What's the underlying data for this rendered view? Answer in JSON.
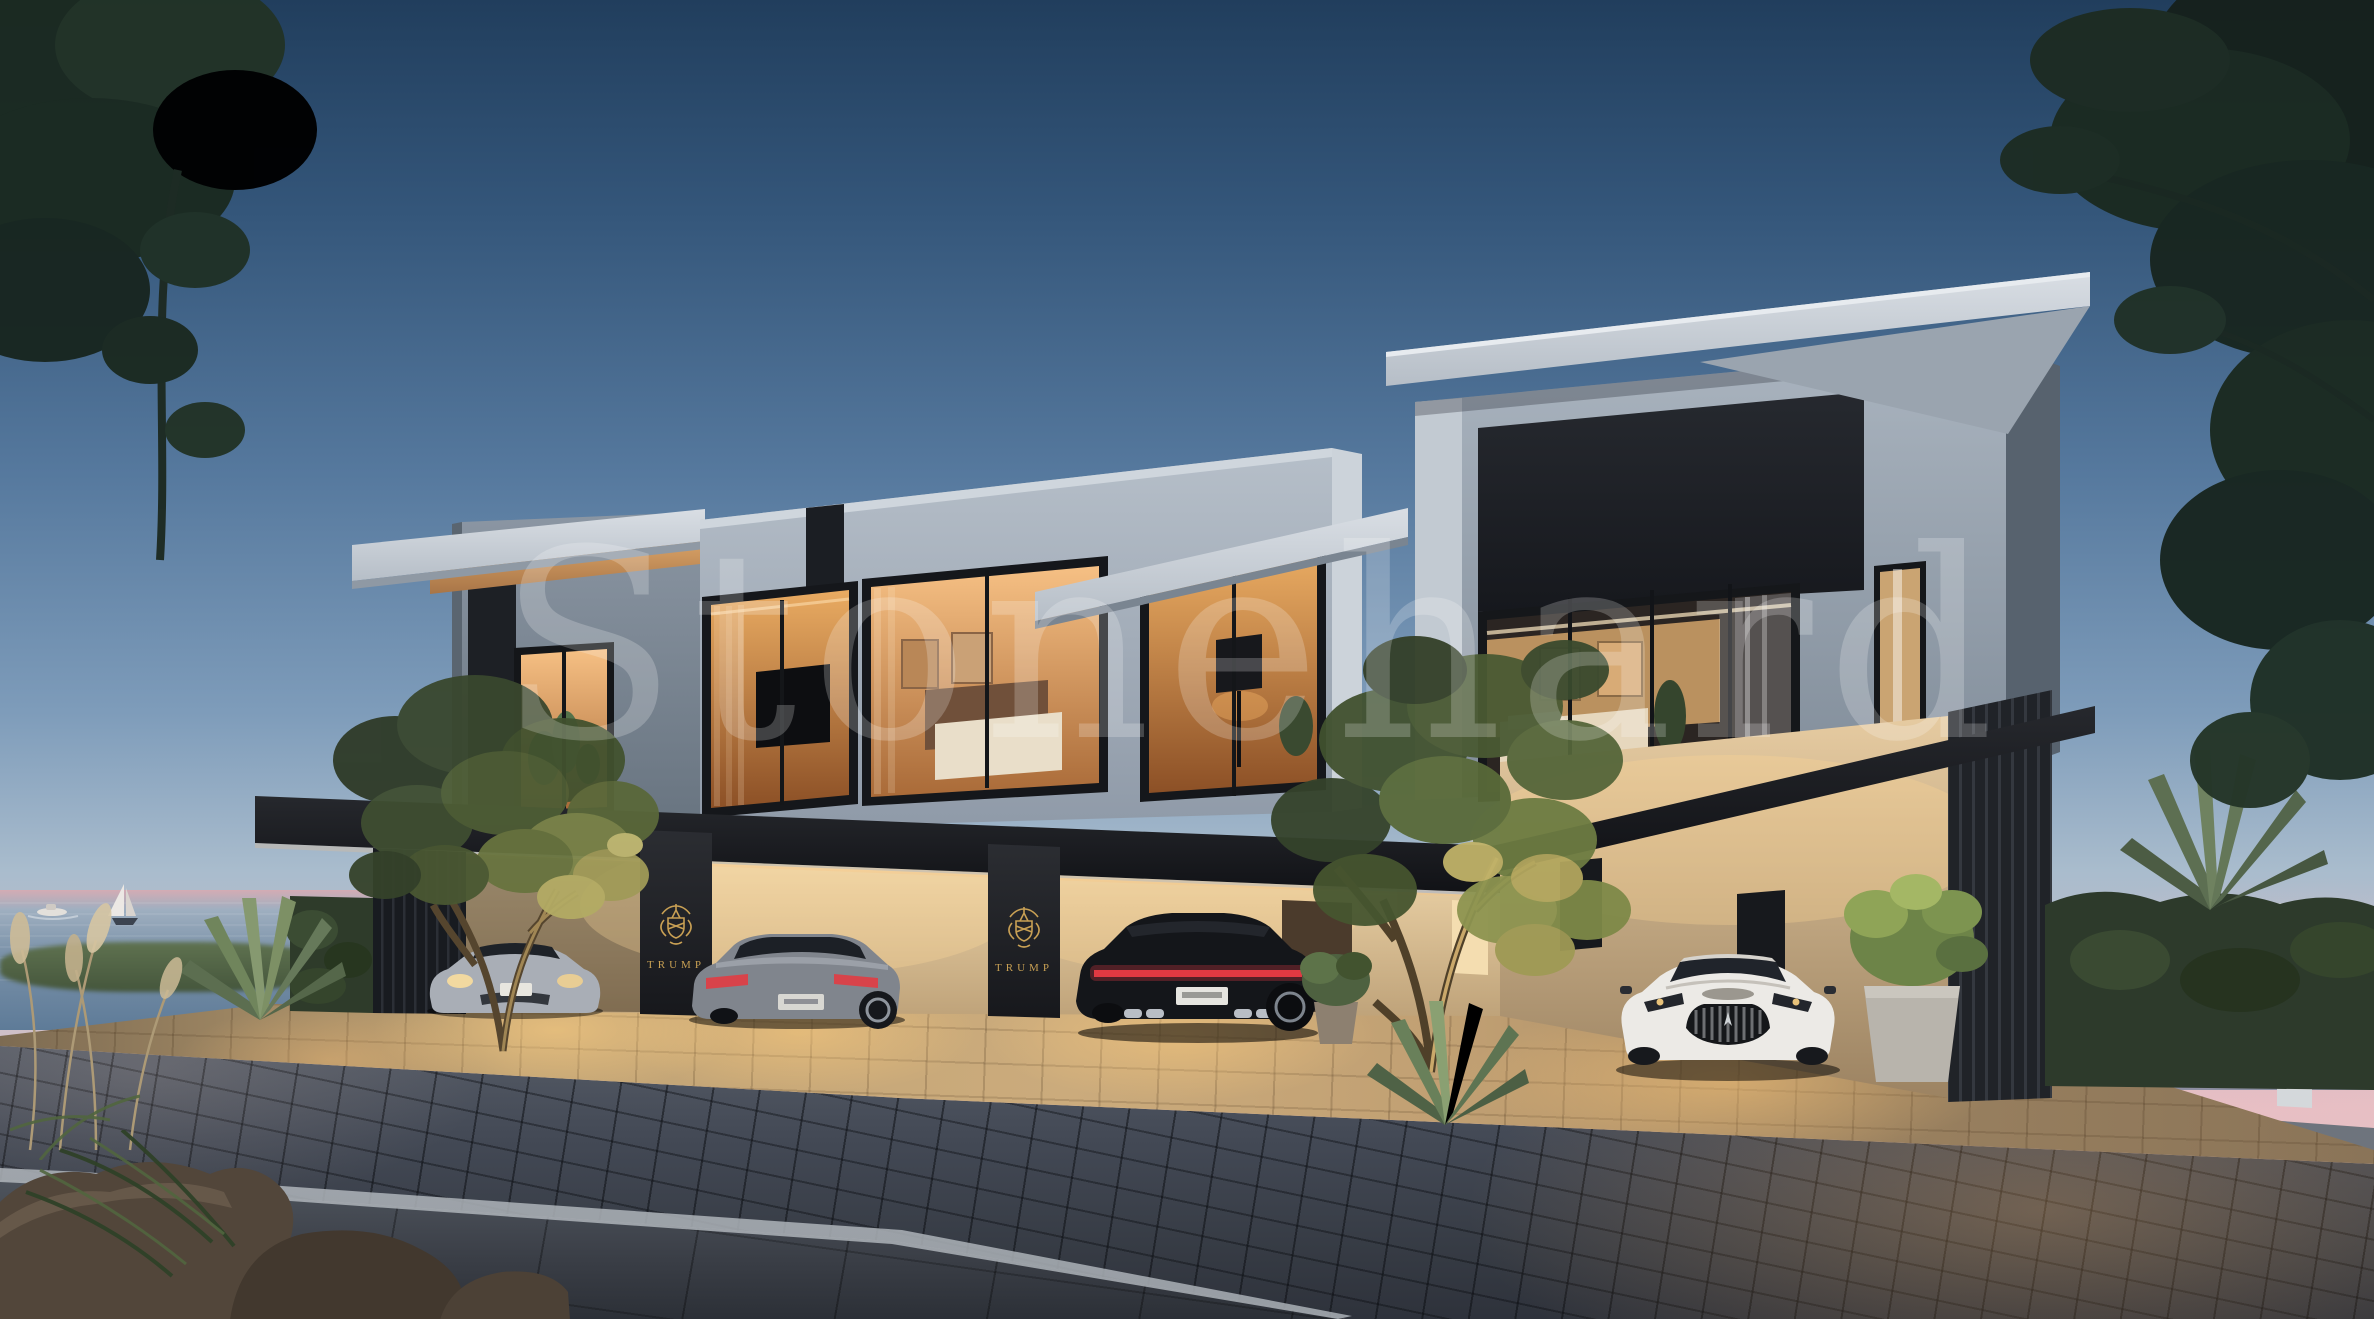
{
  "image": {
    "title": "Twilight architectural rendering of three modern seaside townhouses with lit carports and luxury cars",
    "width": 2374,
    "height": 1319
  },
  "watermark": {
    "text": "Stonehard",
    "opacity": 0.21
  },
  "branding": {
    "crest_label": "TRUMP",
    "crest_icon": "heraldic-crest",
    "instances": 2
  },
  "scene": {
    "time_of_day": "dusk",
    "houses": 3,
    "cars": [
      {
        "slot": "left-carport-left",
        "appearance": "silver sports coupe, front view, headlights lit"
      },
      {
        "slot": "left-carport-right",
        "appearance": "grey luxury coupe, rear view"
      },
      {
        "slot": "middle-carport",
        "appearance": "black sports car, rear view, red light bar"
      },
      {
        "slot": "right-carport",
        "appearance": "white grand tourer, front view, chrome grille"
      }
    ],
    "water": {
      "vessels": [
        "sailboat",
        "motorboat"
      ]
    },
    "foreground": [
      "cobblestone street",
      "stone sidewalk",
      "boulders",
      "agave and grasses"
    ],
    "landscaping": [
      "uplit olive trees",
      "potted plants",
      "hedge",
      "yucca"
    ]
  },
  "colors": {
    "sky-top": "#213e5d",
    "sky-mid": "#7e9cba",
    "sky-low": "#c6bfc9",
    "sky-horizon": "#e6c1c6",
    "sea": "#7b92a9",
    "marble-lit": "#d6dbe1",
    "marble-mid": "#a9b3bf",
    "marble-shadow": "#7b8794",
    "bronze-dark": "#1d2024",
    "wood-soffit": "#c6904f",
    "warm-wall": "#e3c89f",
    "window-glow": "#f0b878",
    "gold": "#c8a054",
    "foliage-dark": "#35432b",
    "foliage-lit": "#8d9450",
    "hedge": "#2d3a2b",
    "driveway-lit": "#c2a475",
    "road": "#434955",
    "sidewalk": "#4e545d",
    "curb": "#d8dbde",
    "rock": "#4c4136",
    "car-silver": "#b7bcc3",
    "car-grey": "#80858d",
    "car-black": "#14161a",
    "car-white": "#eceae6",
    "taillight-red": "#d8434a"
  }
}
